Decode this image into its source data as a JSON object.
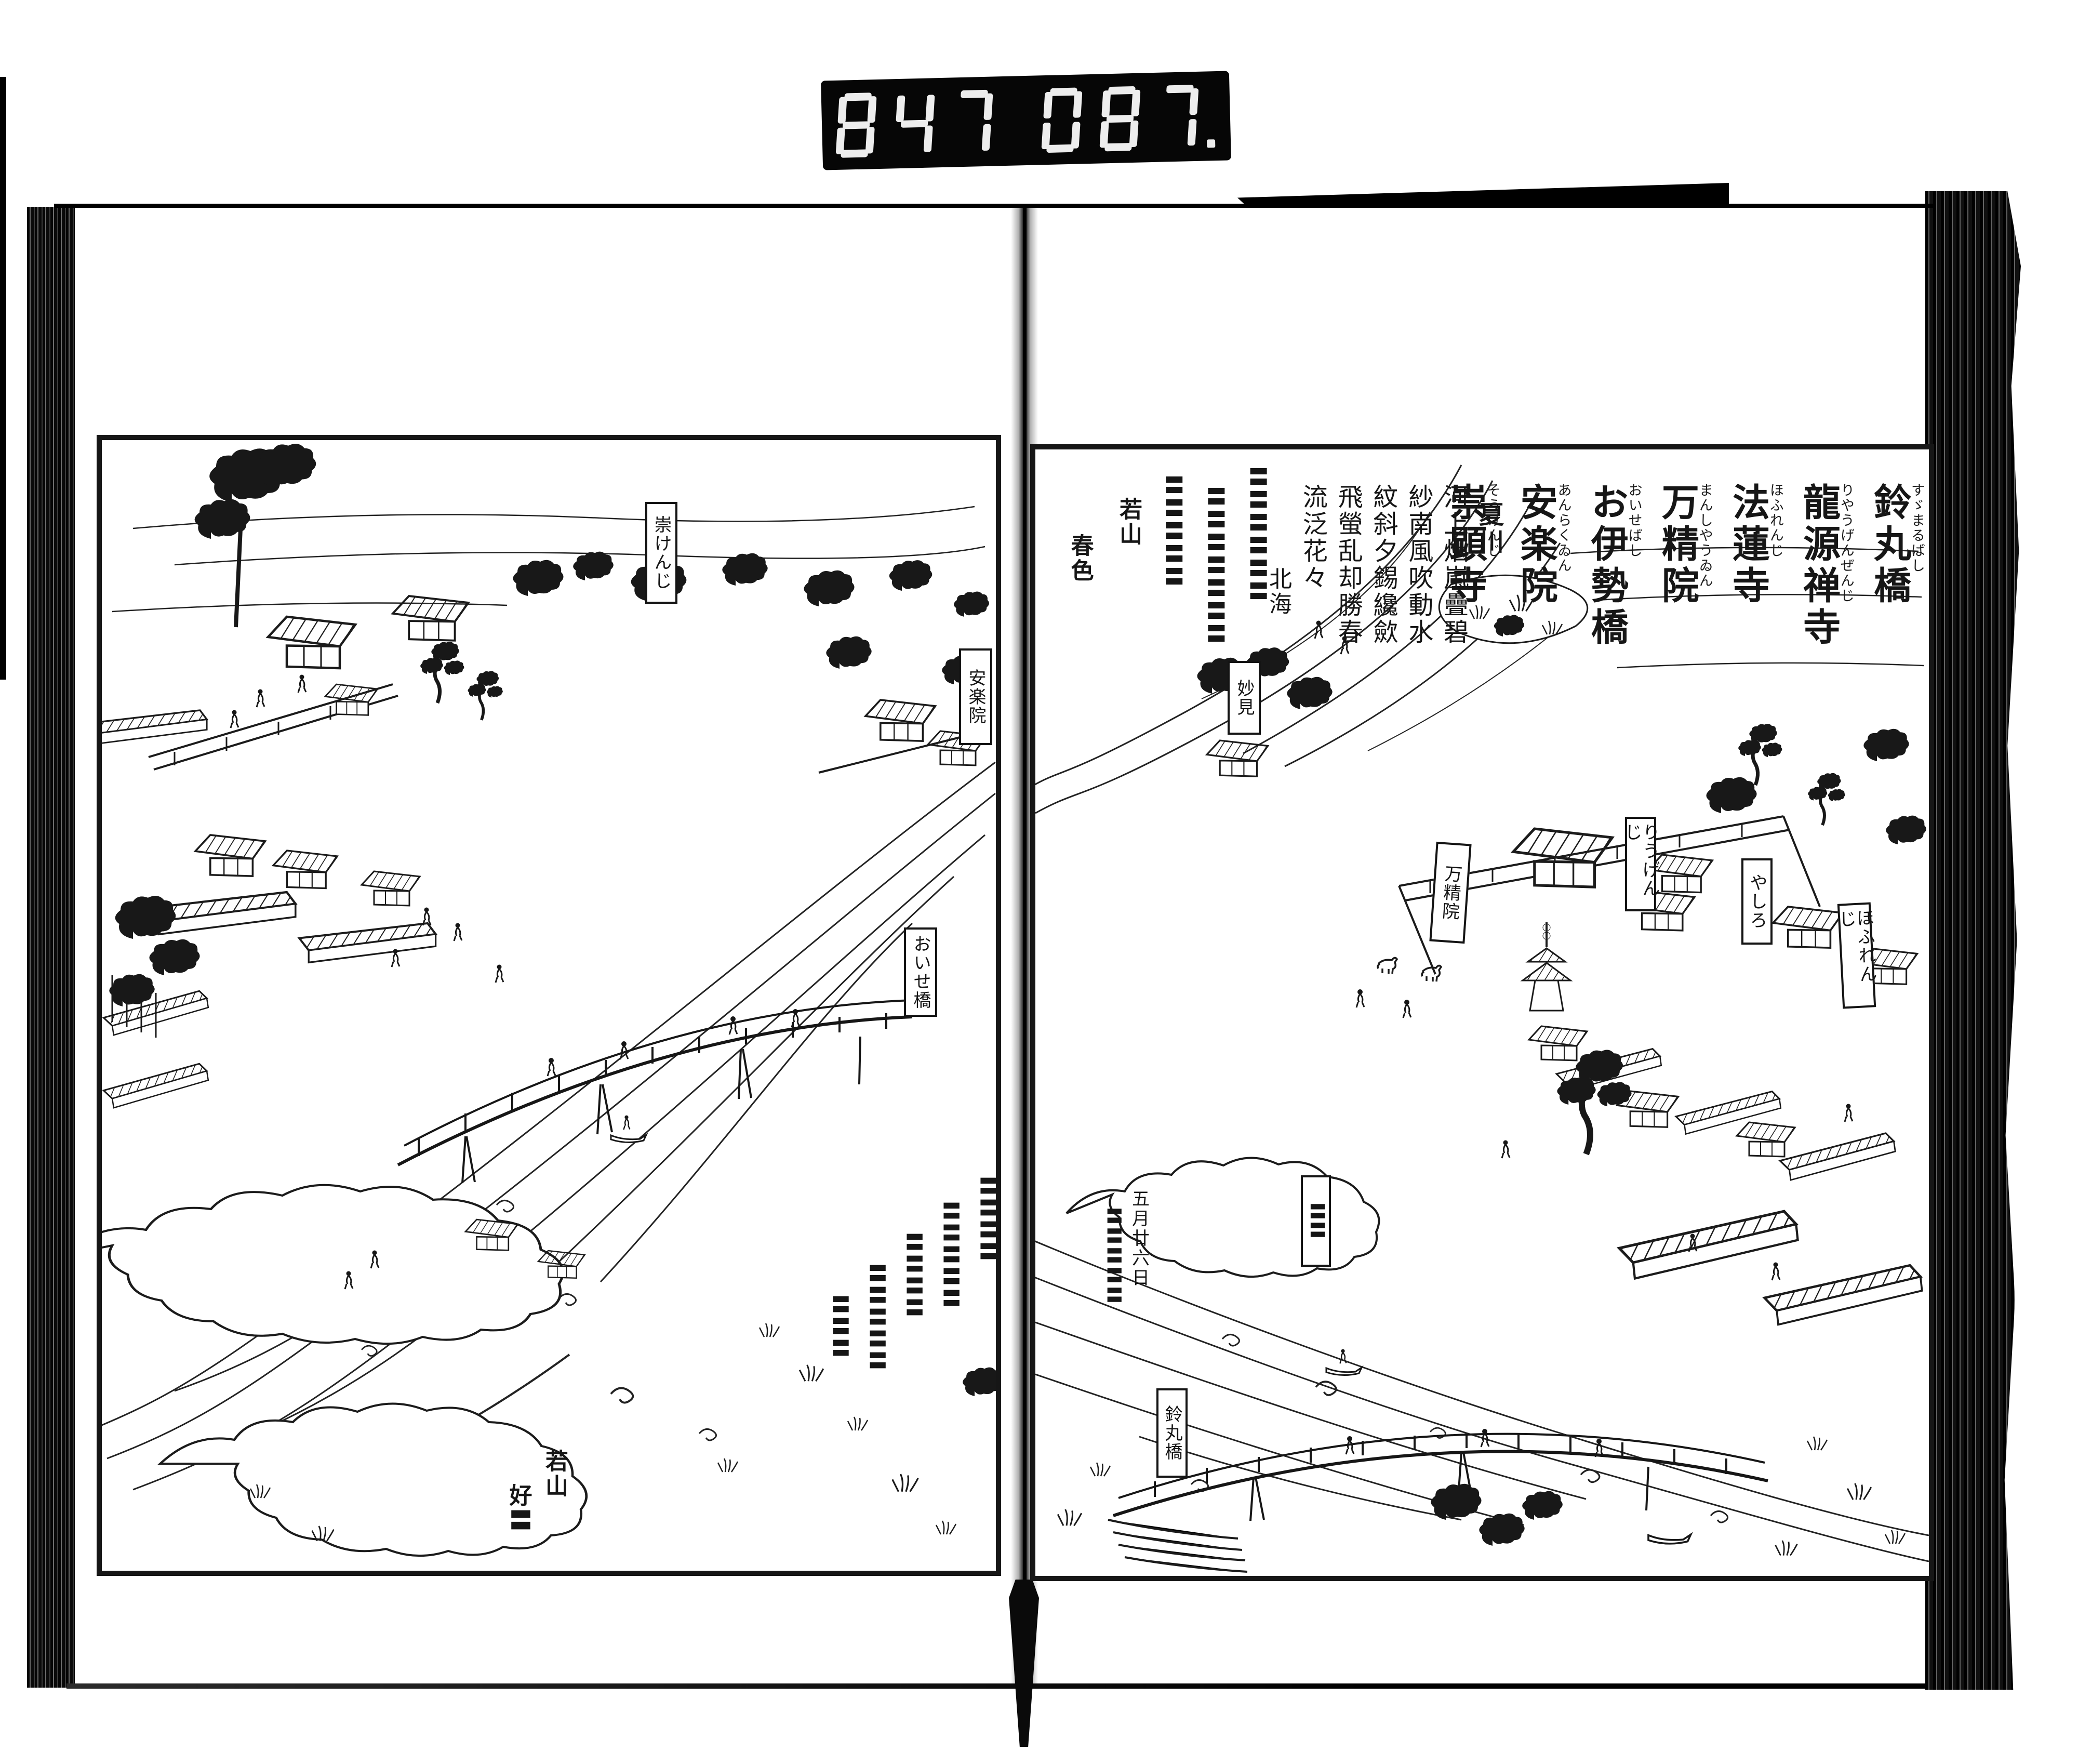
{
  "frame_counter": {
    "left_digits": "847",
    "right_digits": "087."
  },
  "right_page": {
    "name_list": [
      {
        "kana": "すゞまるばし",
        "kanji": "鈴丸橋"
      },
      {
        "kana": "りやうげんぜんじ",
        "kanji": "龍源禅寺"
      },
      {
        "kana": "ほふれんじ",
        "kanji": "法蓮寺"
      },
      {
        "kana": "まんしやうゐん",
        "kanji": "万精院"
      },
      {
        "kana": "おいせばし",
        "kanji": "お伊勢橋"
      },
      {
        "kana": "あんらくゐん",
        "kanji": "安楽院"
      },
      {
        "kana": "そうけんじ",
        "kanji": "崇顕寺"
      }
    ],
    "kanshi": {
      "title": "夏川",
      "columns": [
        "河上烟嵐疊碧",
        "紗南風吹動水",
        "紋斜夕錫纔歛",
        "飛螢乱却勝春",
        "流泛花々"
      ],
      "signature": "北海"
    },
    "waka": {
      "columns": [
        "〓〓〓〓〓〓",
        "〓〓〓〓〓〓〓",
        "〓〓〓〓〓"
      ],
      "signature": [
        "若山",
        "春色"
      ]
    },
    "river_note": {
      "date": "五月廿六日",
      "note": "〓〓〓〓〓"
    },
    "cartouches": {
      "myoken": "妙見",
      "manshoin": "万精院",
      "ryugenji": "りうげんじ",
      "yashiro": "やしろ",
      "horenji": "ほふれんじ",
      "suzumarubashi": "鈴丸橋",
      "unread": "〓〓"
    }
  },
  "left_page": {
    "cartouches": {
      "sokenji": "崇けんじ",
      "anrakuin": "安楽院",
      "oisebashi": "おいせ橋"
    },
    "verse": {
      "columns": [
        "〓〓〓〓",
        "〓〓〓〓〓",
        "〓〓〓〓",
        "〓〓〓〓〓",
        "〓〓〓"
      ],
      "signature": [
        "若山",
        "好〓"
      ]
    }
  }
}
